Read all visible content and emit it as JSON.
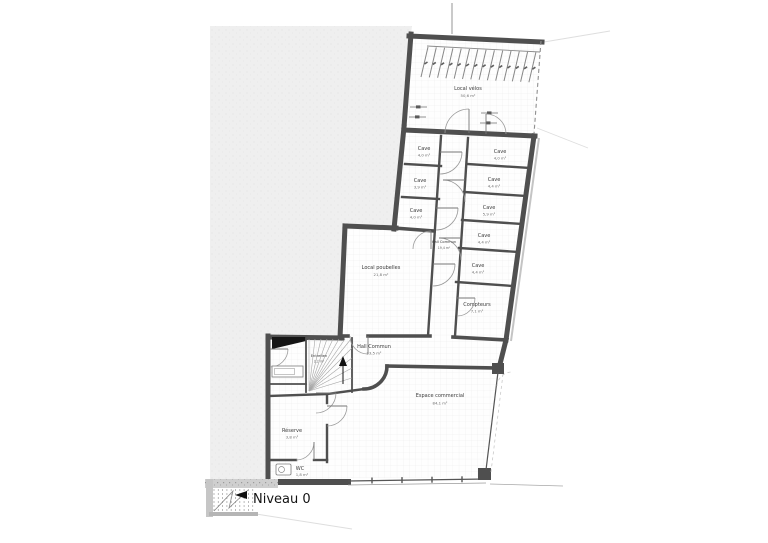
{
  "drawing": {
    "level_label": "Niveau 0",
    "rooms": {
      "velos": {
        "name": "Local vélos",
        "area": "50,6 m²"
      },
      "cave_l1": {
        "name": "Cave",
        "area": "4,0 m²"
      },
      "cave_l2": {
        "name": "Cave",
        "area": "3,9 m²"
      },
      "cave_l3": {
        "name": "Cave",
        "area": "4,0 m²"
      },
      "cave_r1": {
        "name": "Cave",
        "area": "4,0 m²"
      },
      "cave_r2": {
        "name": "Cave",
        "area": "4,4 m²"
      },
      "cave_r3": {
        "name": "Cave",
        "area": "5,9 m²"
      },
      "cave_r4": {
        "name": "Cave",
        "area": "4,4 m²"
      },
      "cave_r5": {
        "name": "Cave",
        "area": "4,4 m²"
      },
      "hall_caves": {
        "name": "Hall Commun",
        "area": "19,4 m²"
      },
      "poubelles": {
        "name": "Local poubelles",
        "area": "21,8 m²"
      },
      "compteurs": {
        "name": "Compteurs",
        "area": "7,1 m²"
      },
      "hall_rdc": {
        "name": "Hall Commun",
        "area": "23,5 m²"
      },
      "entretien": {
        "name": "Entretien",
        "area": "2,2 m²"
      },
      "espace": {
        "name": "Espace commercial",
        "area": "84,1 m²"
      },
      "reserve": {
        "name": "Réserve",
        "area": "3,8 m²"
      },
      "wc": {
        "name": "WC",
        "area": "1,8 m²"
      }
    },
    "colors": {
      "wall": "#4f4f4f",
      "site_fill": "#efefef",
      "grid_line": "#eaeaea",
      "label_text": "#3c3c3c"
    }
  }
}
